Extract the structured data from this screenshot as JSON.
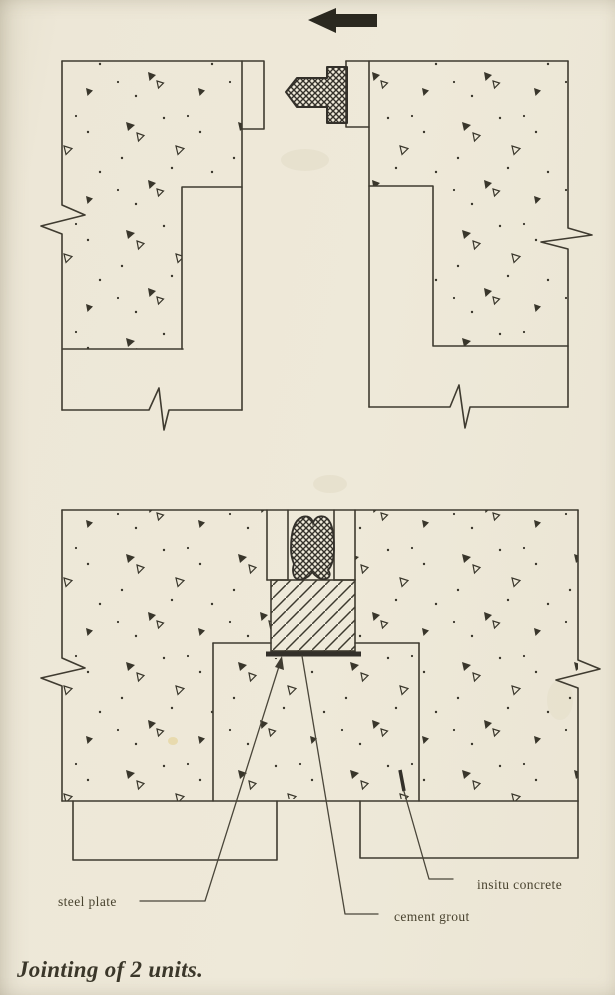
{
  "figure": {
    "caption": "Jointing of 2 units.",
    "labels": {
      "steel_plate": "steel plate",
      "cement_grout": "cement grout",
      "insitu_concrete": "insitu concrete"
    },
    "icons": {
      "direction_arrow": "left-arrow"
    },
    "colors": {
      "paper": "#ece6d5",
      "ink": "#3f3b30",
      "arrow": "#2b2920",
      "label_text": "#49432f"
    }
  }
}
